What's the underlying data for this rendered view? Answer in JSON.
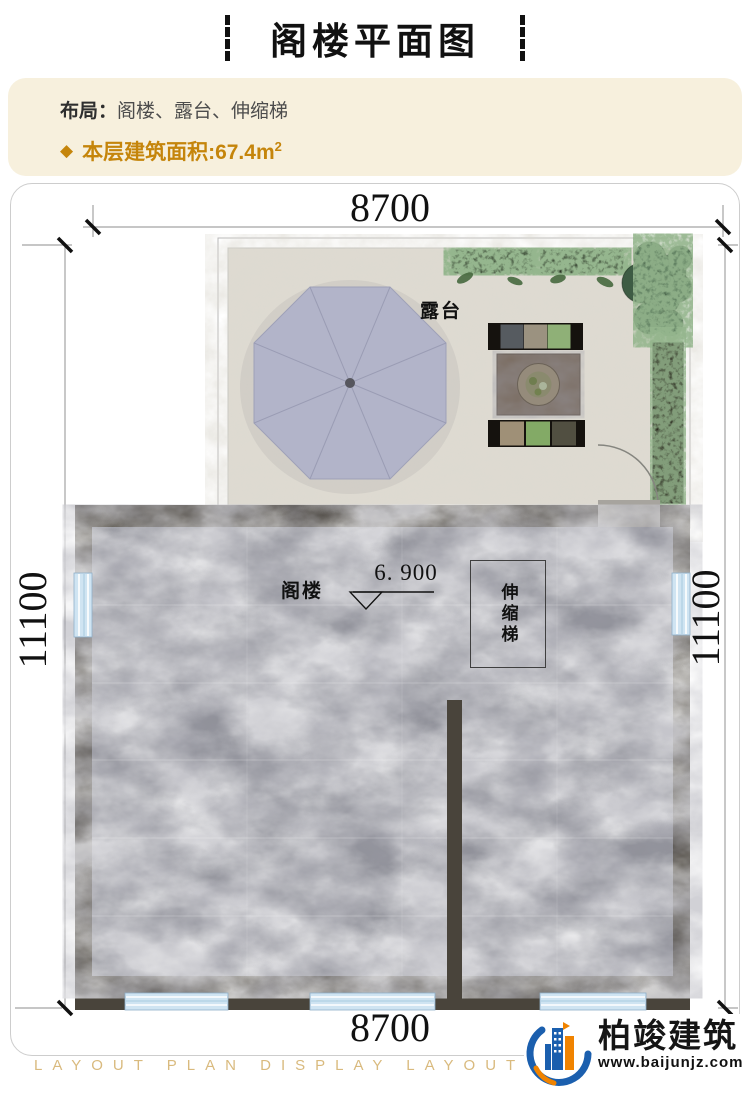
{
  "header": {
    "title": "阁楼平面图"
  },
  "info": {
    "layout_label": "布局：",
    "layout_value": "阁楼、露台、伸缩梯",
    "area_icon": "◆",
    "area_label": "本层建筑面积:67.4m",
    "area_sup": "2"
  },
  "plan": {
    "dim_top": "8700",
    "dim_bottom": "8700",
    "dim_left": "11100",
    "dim_right": "11100",
    "room_terrace": "露台",
    "room_attic": "阁楼",
    "room_ladder": "伸缩梯",
    "elevation": "6. 900"
  },
  "brand": {
    "name": "柏竣建筑",
    "website": "www.baijunjz.com"
  },
  "watermark": "LAYOUT PLAN DISPLAY LAYOUT PLAN DISPLAY",
  "colors": {
    "accent_gold": "#c5850b",
    "info_bg": "#f7f0dd",
    "wall": "#49443b",
    "marble_floor": "#8f9098",
    "terrace_stone": "#dedad1",
    "umbrella": "#b2b4c9",
    "window_blue": "#cfe4f2",
    "brand_blue": "#1b5fae",
    "brand_orange": "#f08300",
    "watermark_gold": "#d9ba7e"
  }
}
